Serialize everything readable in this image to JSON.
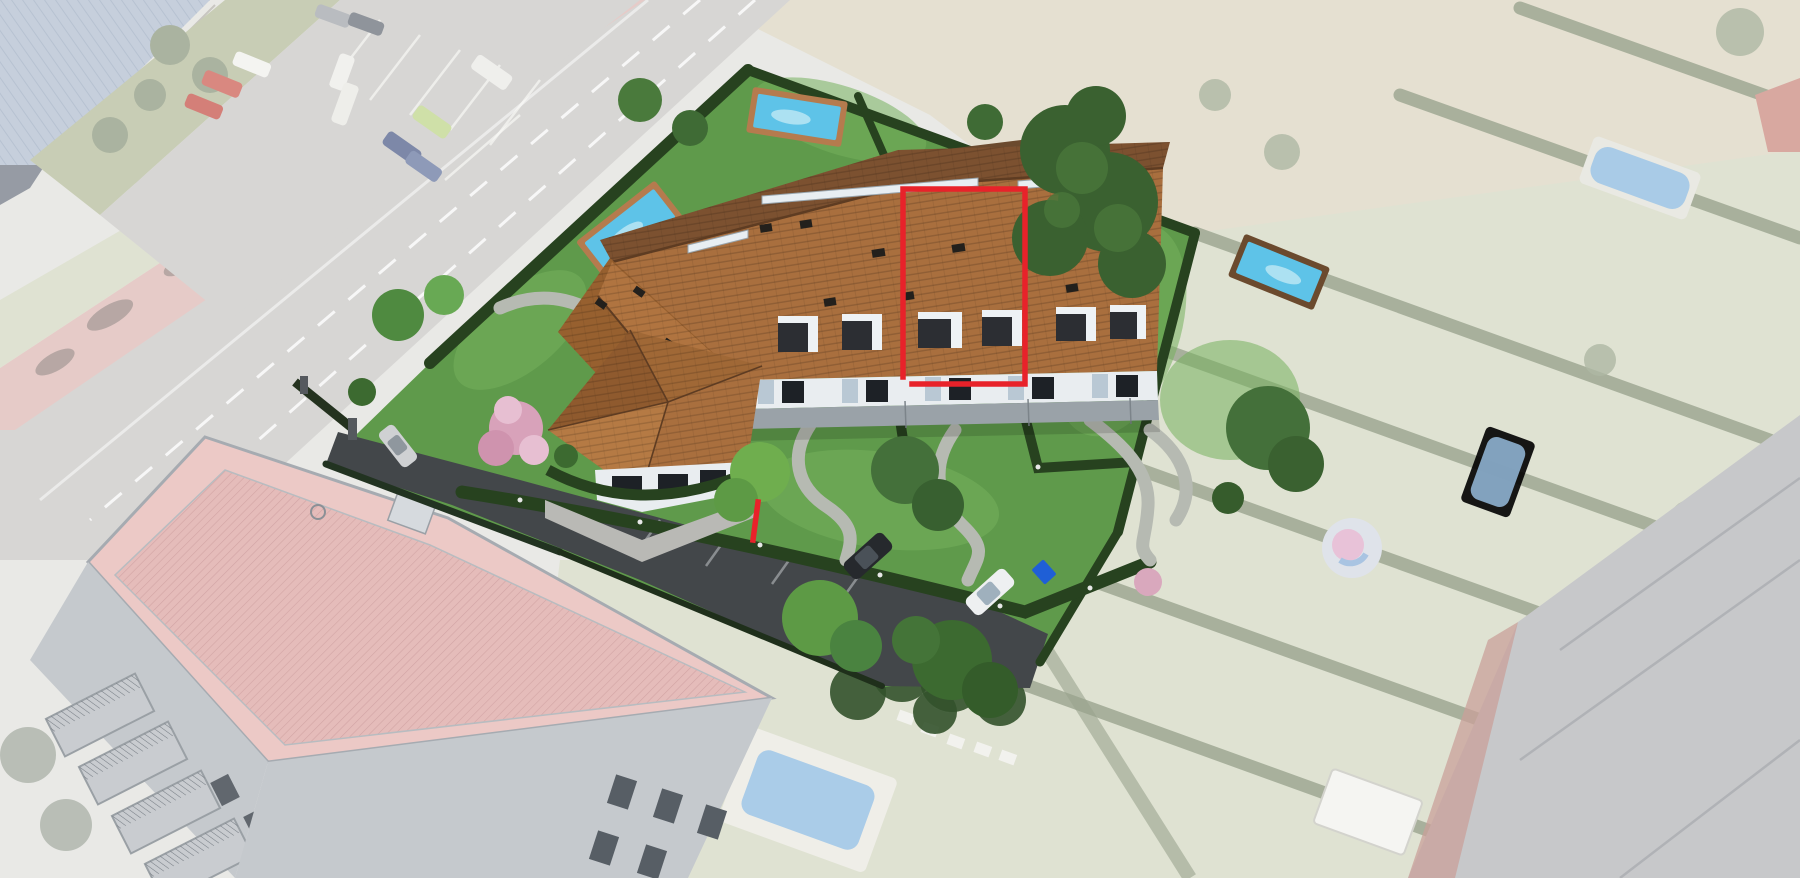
{
  "scene": {
    "type": "aerial-architectural-render",
    "description": "3D render of a small residential development superimposed on a faded aerial photo; one townhouse unit is outlined in red",
    "highlight": {
      "label": "highlighted-unit",
      "outline_color": "#e8222a"
    },
    "palette": {
      "accent-red": "#e8222a",
      "roof-front": "#a96f3e",
      "roof-back": "#7c5130",
      "grass": "#5f9a4b",
      "grass-light": "#74b05c",
      "hedge": "#27421f",
      "path-gray": "#b6bab2",
      "driveway": "#43474a",
      "pool-water": "#5ec3e8",
      "pool-deck": "#b57b4e",
      "pool-deck-dark": "#6b4a2e",
      "facade-white": "#e9edf0",
      "road": "#d7d6d4",
      "faded-field": "#e5e0d1",
      "faded-grass": "#dfe2d2",
      "faded-hedge": "#9aa48e",
      "faded-pool": "#9ec6e8",
      "pink-roof": "#ecc9c6",
      "pink-roof-inner": "#e5bcba",
      "sketch-gray": "#c5c9cd",
      "industrial-roof": "#c6cfdc",
      "big-roof": "#c7c8ca"
    },
    "counts": {
      "rendered_garden_pools": 4,
      "driveway_cars": 2,
      "street_cars_rendered": 2,
      "faded_neighbor_pools": 3
    }
  }
}
